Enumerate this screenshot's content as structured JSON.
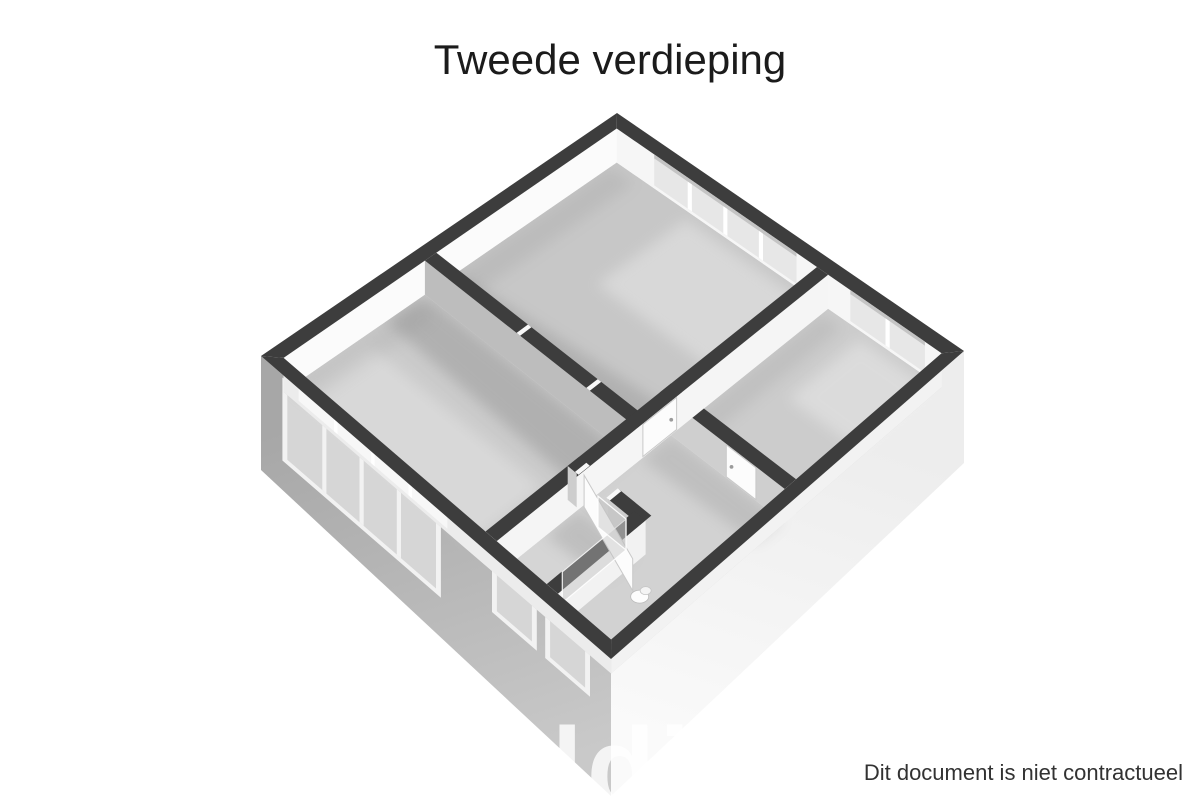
{
  "page": {
    "title": "Tweede verdieping",
    "disclaimer": "Dit document is niet contractueel",
    "watermark": "addit"
  },
  "plan": {
    "corners": {
      "T": [
        617,
        147
      ],
      "R": [
        964,
        385
      ],
      "B": [
        611,
        693
      ],
      "L": [
        261,
        390
      ]
    },
    "wall_height": 34,
    "half_thickness": 0.016,
    "skirt_drop": {
      "L": 80,
      "B": 103,
      "R": 78
    },
    "colors": {
      "cap": "#3d3d3d",
      "face_nw": "#fbfbfb",
      "face_ne": "#f6f6f6",
      "strip_sw": "#ececec",
      "strip_se": "#f2f2f2",
      "glass_in": "#e7e7e7",
      "frame_in": "#ffffff",
      "reveal": "#c4c4c4",
      "skirt_sw_top": "#a7a7a7",
      "skirt_sw_bot": "#c9c9c9",
      "skirt_se_top": "#ededed",
      "skirt_se_bot": "#fafafa",
      "facade_frame": "#f2f2f2",
      "facade_glass": "#d6d6d6",
      "door": "#fcfcfc",
      "door_edge": "#c9c9c9",
      "handle": "#9b9b9b",
      "jamb": "#f8f8f8",
      "glasswall": "rgba(190,190,190,0.42)",
      "glassedge": "rgba(255,255,255,0.9)",
      "watermark_fill": "rgba(255,255,255,0.8)"
    },
    "rooms": [
      {
        "id": "room-large",
        "fill": "#c7c7c7",
        "pts": [
          [
            0.032,
            0.032
          ],
          [
            0.61,
            0.032
          ],
          [
            0.61,
            0.539
          ],
          [
            0.032,
            0.539
          ]
        ]
      },
      {
        "id": "room-right",
        "fill": "#cccccc",
        "pts": [
          [
            0.641,
            0.032
          ],
          [
            0.968,
            0.032
          ],
          [
            0.968,
            0.444
          ],
          [
            0.641,
            0.444
          ]
        ]
      },
      {
        "id": "room-left",
        "fill": "#cbcbcb",
        "pts": [
          [
            0.032,
            0.571
          ],
          [
            0.609,
            0.571
          ],
          [
            0.609,
            0.968
          ],
          [
            0.032,
            0.968
          ]
        ]
      },
      {
        "id": "room-hall",
        "fill": "#d2d2d2",
        "pts": [
          [
            0.641,
            0.476
          ],
          [
            0.968,
            0.476
          ],
          [
            0.968,
            0.968
          ],
          [
            0.641,
            0.968
          ]
        ]
      },
      {
        "id": "room-bathroom",
        "fill": "#d5d5d5",
        "pts": [
          [
            0.641,
            0.736
          ],
          [
            0.784,
            0.736
          ],
          [
            0.784,
            0.968
          ],
          [
            0.641,
            0.968
          ]
        ]
      }
    ],
    "shadows": [
      {
        "pts": [
          [
            0.05,
            0.545
          ],
          [
            0.61,
            0.545
          ],
          [
            0.61,
            0.43
          ],
          [
            0.05,
            0.48
          ]
        ],
        "op": 0.3
      },
      {
        "pts": [
          [
            0.032,
            0.571
          ],
          [
            0.62,
            0.571
          ],
          [
            0.62,
            0.7
          ],
          [
            0.032,
            0.68
          ]
        ],
        "op": 0.34
      },
      {
        "pts": [
          [
            0.032,
            0.05
          ],
          [
            0.1,
            0.05
          ],
          [
            0.1,
            0.545
          ],
          [
            0.032,
            0.545
          ]
        ],
        "op": 0.15
      },
      {
        "pts": [
          [
            0.032,
            0.6
          ],
          [
            0.09,
            0.6
          ],
          [
            0.09,
            0.95
          ],
          [
            0.032,
            0.95
          ]
        ],
        "op": 0.12
      },
      {
        "pts": [
          [
            0.641,
            0.476
          ],
          [
            0.96,
            0.476
          ],
          [
            0.96,
            0.55
          ],
          [
            0.641,
            0.56
          ]
        ],
        "op": 0.22
      },
      {
        "pts": [
          [
            0.641,
            0.736
          ],
          [
            0.8,
            0.736
          ],
          [
            0.8,
            0.82
          ],
          [
            0.641,
            0.83
          ]
        ],
        "op": 0.25
      },
      {
        "pts": [
          [
            0.641,
            0.05
          ],
          [
            0.7,
            0.05
          ],
          [
            0.7,
            0.44
          ],
          [
            0.641,
            0.44
          ]
        ],
        "op": 0.15
      }
    ],
    "lights": [
      {
        "pts": [
          [
            0.25,
            0.05
          ],
          [
            0.6,
            0.05
          ],
          [
            0.6,
            0.3
          ],
          [
            0.25,
            0.3
          ]
        ],
        "op": 0.3
      },
      {
        "pts": [
          [
            0.75,
            0.05
          ],
          [
            0.95,
            0.05
          ],
          [
            0.95,
            0.25
          ],
          [
            0.75,
            0.25
          ]
        ],
        "op": 0.3
      },
      {
        "pts": [
          [
            0.06,
            0.75
          ],
          [
            0.55,
            0.75
          ],
          [
            0.55,
            0.95
          ],
          [
            0.06,
            0.95
          ]
        ],
        "op": 0.25
      }
    ],
    "interior_walls": [
      {
        "id": "wall-large-left",
        "dir": "u",
        "at": 0.555,
        "from": 0.032,
        "to": 0.641,
        "face": "#bdbdbd",
        "frames": [
          0.3,
          0.5
        ]
      },
      {
        "id": "wall-right-hall",
        "dir": "u",
        "at": 0.46,
        "from": 0.609,
        "to": 0.968,
        "face": "#cfcfcf",
        "door": {
          "from": 0.8,
          "to": 0.885,
          "handle": 0.815
        }
      },
      {
        "id": "wall-central",
        "dir": "v",
        "at": 0.625,
        "from": 0.032,
        "to": 0.968,
        "face": "#f5f5f5",
        "door": {
          "from": 0.46,
          "to": 0.555,
          "handle": 0.475
        }
      },
      {
        "id": "wall-bath-front",
        "dir": "u",
        "at": 0.72,
        "from": 0.609,
        "to": 0.816,
        "face": "#cdcdcd",
        "gap": [
          0.635,
          0.725
        ]
      },
      {
        "id": "wall-bath-side",
        "dir": "v",
        "at": 0.8,
        "from": 0.72,
        "to": 0.968,
        "face": "#f2f2f2"
      }
    ],
    "windows_ne": [
      {
        "id": "window-large-room",
        "from": 0.14,
        "to": 0.55,
        "mullions": [
          0.2425,
          0.345,
          0.4475
        ]
      },
      {
        "id": "window-right-room",
        "from": 0.705,
        "to": 0.92,
        "mullions": [
          0.8125
        ]
      }
    ],
    "windows_sw": [
      {
        "id": "window-left-room",
        "from": 0.075,
        "to": 0.5,
        "mullions": [
          0.181,
          0.2875,
          0.394
        ],
        "top": -26,
        "bottom": 47
      },
      {
        "id": "window-bath-small-1",
        "from": 0.674,
        "to": 0.774,
        "mullions": [],
        "top": -30,
        "bottom": 17
      },
      {
        "id": "window-bath-small-2",
        "from": 0.826,
        "to": 0.926,
        "mullions": [],
        "top": -30,
        "bottom": 17
      }
    ],
    "open_door": {
      "hinge": [
        0.645,
        0.725
      ],
      "end": [
        0.86,
        0.8
      ]
    },
    "shower_glass": [
      {
        "a": [
          0.78,
          0.74
        ],
        "b": [
          0.78,
          0.92
        ]
      },
      {
        "a": [
          0.7,
          0.74
        ],
        "b": [
          0.78,
          0.74
        ]
      }
    ],
    "toilet": {
      "at": [
        0.88,
        0.8
      ]
    }
  }
}
